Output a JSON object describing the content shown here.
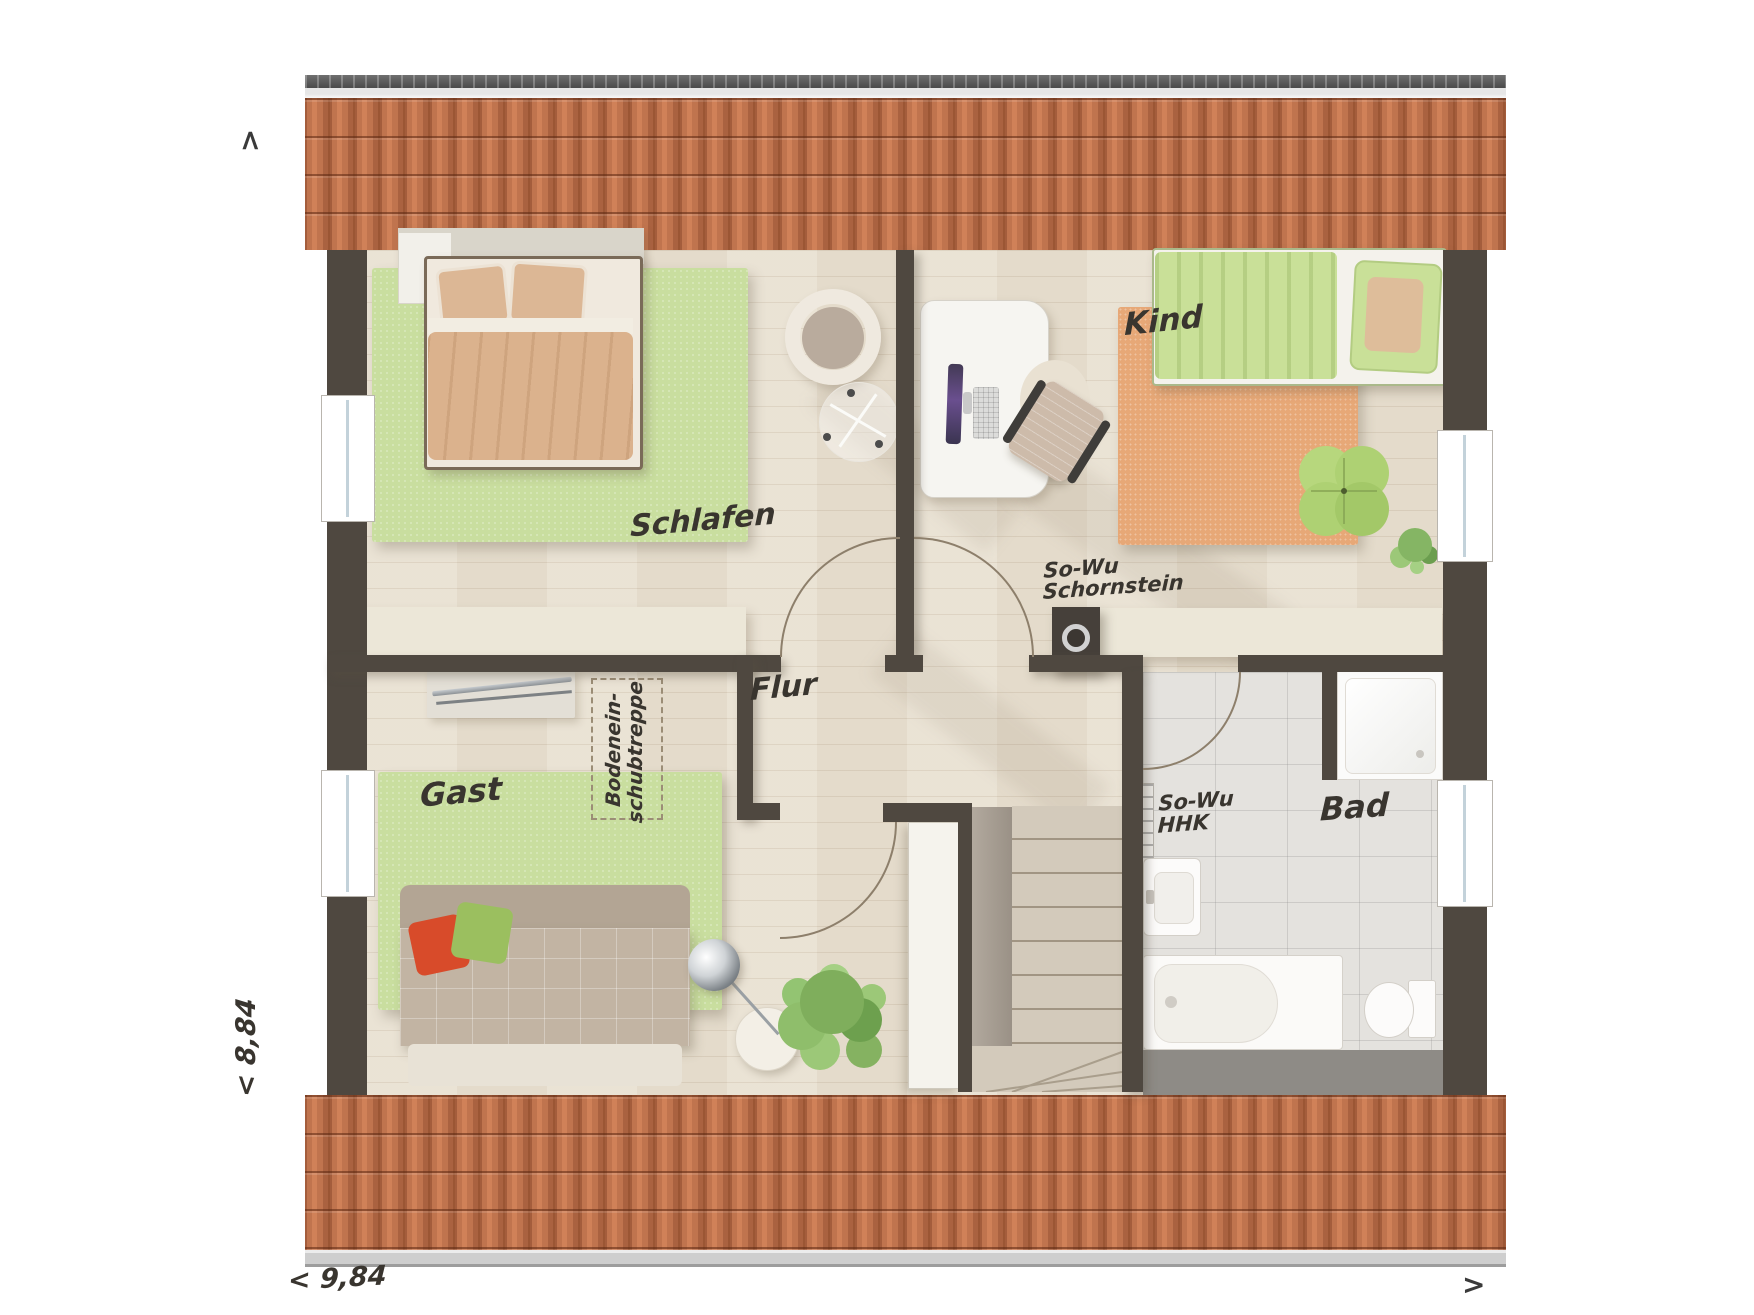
{
  "plan_title": "attic-floor-plan",
  "rooms": {
    "schlafen": "Schlafen",
    "kind": "Kind",
    "gast": "Gast",
    "flur": "Flur",
    "bad": "Bad"
  },
  "annotations": {
    "chimney": {
      "line1": "So-Wu",
      "line2": "Schornstein"
    },
    "radiator": {
      "line1": "So-Wu",
      "line2": "HHK"
    },
    "loft_ladder": {
      "line1": "Bodenein-",
      "line2": "schubtreppe"
    }
  },
  "dimensions": {
    "width": "< 9,84",
    "depth": "< 8,84"
  },
  "arrows": {
    "up": ">",
    "right": ">"
  },
  "palette": {
    "roof_tile": "#c0744e",
    "wall": "#4f4840",
    "wood_floor": "#e9e1d2",
    "bath_tile": "#e4e2de",
    "rug_green": "#c9de9f",
    "rug_orange": "#e7a877",
    "shelf_cream": "#ece7d8",
    "bed_tan": "#dbb28d",
    "kid_green": "#c9e098",
    "cushion_red": "#d84b2a",
    "cushion_green": "#9bbf5f"
  }
}
